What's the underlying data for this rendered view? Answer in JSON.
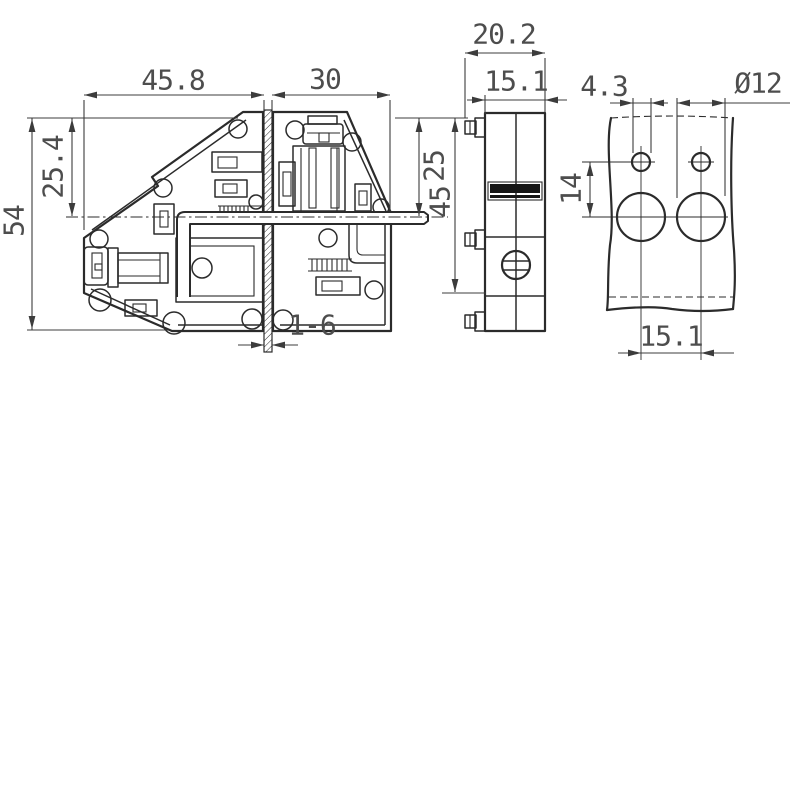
{
  "colors": {
    "line": "#2b2b2b",
    "dimension_line": "#3c3c3c",
    "label_text": "#4d4d4d",
    "background": "#ffffff",
    "marking_band": "#151515"
  },
  "views": {
    "side_section": {
      "dimensions": {
        "overall_width_left": "45.8",
        "overall_width_right": "30",
        "upper_height": "25.4",
        "total_height": "54",
        "right_upper_height": "25",
        "right_height": "45",
        "partition_thickness_range": "1-6"
      }
    },
    "front": {
      "dimensions": {
        "overall_depth": "20.2",
        "body_depth": "15.1"
      }
    },
    "drilling_plan": {
      "dimensions": {
        "pilot_hole_diameter": "4.3",
        "main_hole_diameter": "Ø12",
        "vertical_hole_pitch": "14",
        "horizontal_hole_pitch": "15.1"
      }
    }
  }
}
